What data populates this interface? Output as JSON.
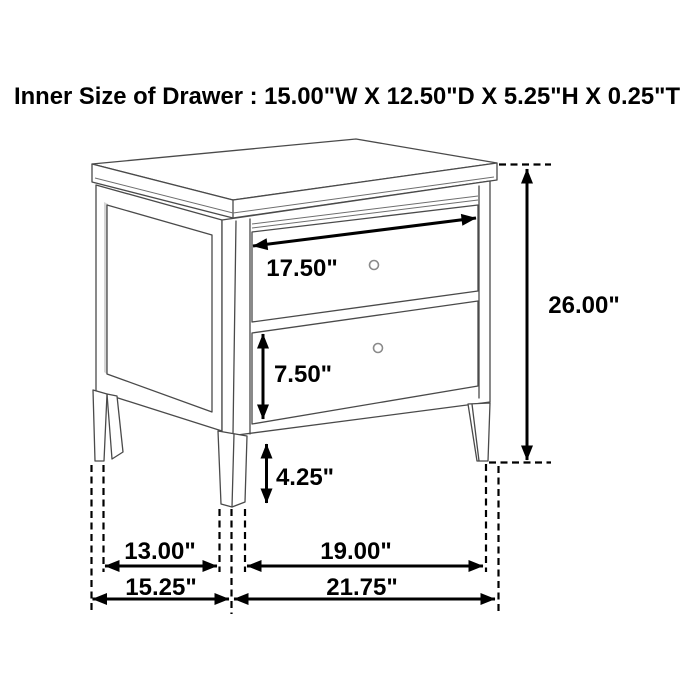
{
  "title": "Inner Size of Drawer : 15.00\"W X 12.50\"D X 5.25\"H X 0.25\"T",
  "diagram": {
    "type": "furniture-dimension-drawing",
    "item": "two-drawer nightstand line drawing",
    "colors": {
      "background": "#ffffff",
      "furniture_line": "#4a4a4a",
      "dimension_line": "#000000",
      "text": "#000000"
    },
    "dims": {
      "drawer_face_width": "17.50\"",
      "overall_height": "26.00\"",
      "drawer_face_height": "7.50\"",
      "leg_height": "4.25\"",
      "depth_inner": "13.00\"",
      "depth_overall": "15.25\"",
      "width_inner": "19.00\"",
      "width_overall": "21.75\""
    }
  }
}
